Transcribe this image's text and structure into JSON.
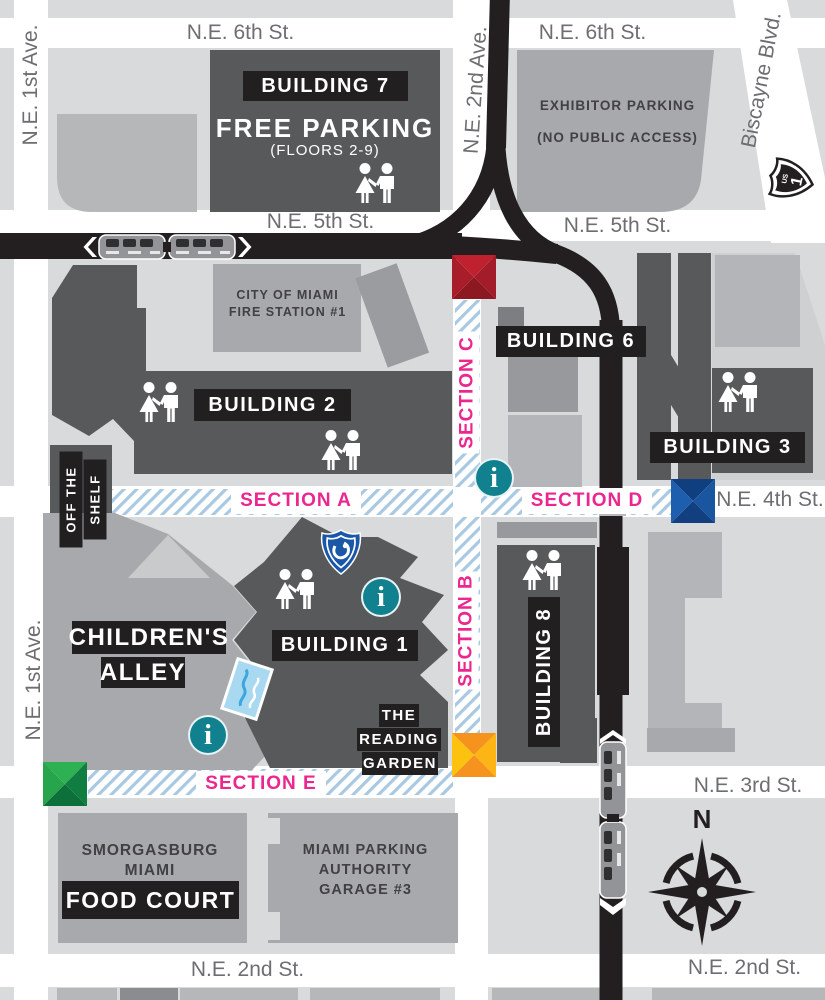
{
  "streets": {
    "ne_6th_st_left": "N.E. 6th St.",
    "ne_6th_st_right": "N.E. 6th St.",
    "ne_5th_st_left": "N.E. 5th St.",
    "ne_5th_st_right": "N.E. 5th St.",
    "ne_4th_st": "N.E. 4th St.",
    "ne_3rd_st": "N.E. 3rd St.",
    "ne_2nd_st_left": "N.E. 2nd St.",
    "ne_2nd_st_right": "N.E. 2nd St.",
    "ne_1st_ave_top": "N.E. 1st Ave.",
    "ne_1st_ave_bottom": "N.E. 1st Ave.",
    "ne_2nd_ave": "N.E. 2nd Ave.",
    "biscayne_blvd": "Biscayne Blvd."
  },
  "sections": {
    "a": "SECTION A",
    "b": "SECTION B",
    "c": "SECTION C",
    "d": "SECTION D",
    "e": "SECTION E"
  },
  "buildings": {
    "building_7": {
      "badge": "BUILDING 7",
      "title": "FREE PARKING",
      "subtitle": "(FLOORS 2-9)"
    },
    "exhibitor_parking": {
      "line1": "EXHIBITOR PARKING",
      "line2": "(NO PUBLIC ACCESS)"
    },
    "fire_station": {
      "line1": "CITY OF MIAMI",
      "line2": "FIRE STATION #1"
    },
    "building_2": {
      "badge": "BUILDING 2"
    },
    "building_6": {
      "badge": "BUILDING 6"
    },
    "building_3": {
      "badge": "BUILDING 3"
    },
    "building_1": {
      "badge": "BUILDING 1"
    },
    "building_8": {
      "badge": "BUILDING 8"
    },
    "off_the_shelf": {
      "line1": "OFF THE",
      "line2": "SHELF"
    },
    "childrens_alley": {
      "line1": "CHILDREN'S",
      "line2": "ALLEY"
    },
    "reading_garden": {
      "line1": "THE",
      "line2": "READING",
      "line3": "GARDEN"
    },
    "food_court": {
      "line1": "SMORGASBURG",
      "line2": "MIAMI",
      "badge": "FOOD COURT"
    },
    "parking_garage": {
      "line1": "MIAMI PARKING",
      "line2": "AUTHORITY",
      "line3": "GARAGE #3"
    }
  },
  "icons": {
    "info_glyph": "i",
    "compass_north": "N",
    "route_shield": {
      "small": "US",
      "number": "1"
    }
  },
  "markers": {
    "red": {
      "light": "#c0212f",
      "dark": "#8c1822"
    },
    "blue": {
      "light": "#1d5fae",
      "dark": "#0f3f7e"
    },
    "orange": {
      "light": "#fdc20f",
      "dark": "#f6921e"
    },
    "green": {
      "light": "#2db153",
      "dark": "#0d6f3a"
    }
  },
  "colors": {
    "section_label_pink": "#ec268f",
    "info_teal": "#12818f",
    "hatch_blue": "#a9c9e2",
    "road_black": "#231f20",
    "building_dark": "#58595b",
    "building_medium": "#a7a9ac",
    "block_light": "#d9dadb",
    "street_white": "#ffffff",
    "street_label_gray": "#6d6e71",
    "caption_gray": "#414042",
    "shield_blue": "#1a57a8",
    "postcard_blue": "#a8d9f1"
  }
}
